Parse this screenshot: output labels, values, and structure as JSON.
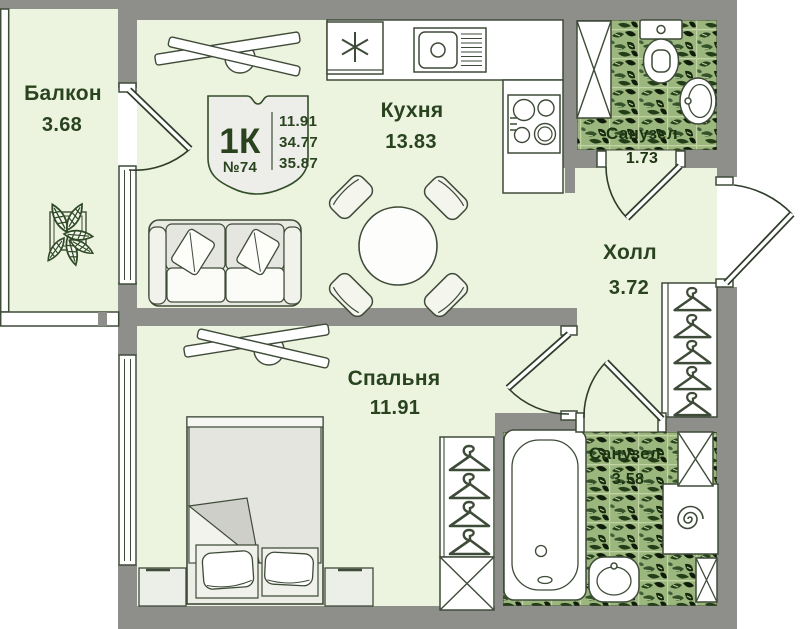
{
  "unit_badge": {
    "type_label": "1К",
    "unit_number": "№74",
    "living_area": "11.91",
    "apartment_area": "34.77",
    "total_area": "35.87"
  },
  "rooms": {
    "balcony": {
      "name": "Балкон",
      "area": "3.68"
    },
    "kitchen": {
      "name": "Кухня",
      "area": "13.83"
    },
    "hall": {
      "name": "Холл",
      "area": "3.72"
    },
    "bedroom": {
      "name": "Спальня",
      "area": "11.91"
    },
    "wc_top": {
      "name": "Санузел",
      "area": "1.73"
    },
    "bathroom": {
      "name": "Санузел",
      "area": "3.58"
    }
  },
  "icons": {
    "fridge": "snowflake-icon",
    "ventilation_shaft": "crossed-box-icon",
    "wardrobe": "hanger-icon",
    "washing_machine": "spiral-drum-icon"
  },
  "colors": {
    "floor": "#ecf3df",
    "wall": "#8e8f8b",
    "outline": "#3f4b39",
    "label_text": "#2a431f",
    "fixture_white": "#ffffff",
    "furniture_fill": "#e9eae2",
    "tile_base": "#9cb77e",
    "tile_dark": "#16290e"
  }
}
